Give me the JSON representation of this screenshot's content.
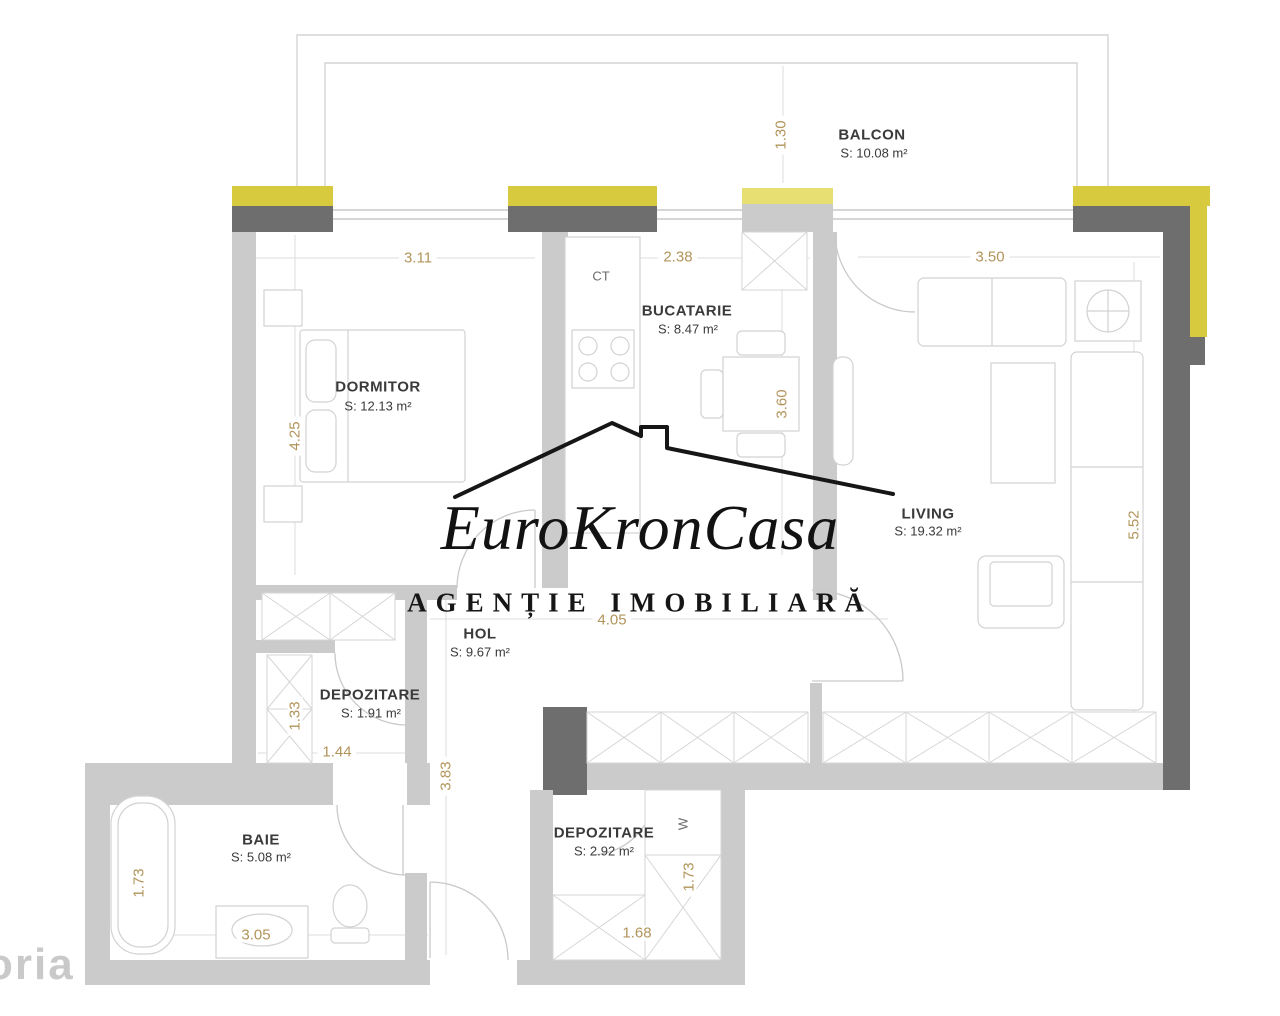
{
  "watermark": {
    "brand_script": "EuroKronCasa",
    "brand_line": "AGENȚIE IMOBILIARĂ",
    "corner": "oria"
  },
  "rooms": {
    "balcon": {
      "name": "BALCON",
      "area": "S: 10.08 m²"
    },
    "dormitor": {
      "name": "DORMITOR",
      "area": "S: 12.13 m²"
    },
    "bucatarie": {
      "name": "BUCATARIE",
      "area": "S: 8.47 m²"
    },
    "living": {
      "name": "LIVING",
      "area": "S: 19.32 m²"
    },
    "hol": {
      "name": "HOL",
      "area": "S: 9.67 m²"
    },
    "depozitare_mic": {
      "name": "DEPOZITARE",
      "area": "S: 1.91 m²"
    },
    "baie": {
      "name": "BAIE",
      "area": "S: 5.08 m²"
    },
    "depozitare_mare": {
      "name": "DEPOZITARE",
      "area": "S: 2.92 m²"
    }
  },
  "dimensions": {
    "balcon_depth": "1.30",
    "dormitor_w": "3.11",
    "bucatarie_w": "2.38",
    "living_w": "3.50",
    "dormitor_h": "4.25",
    "bucatarie_h": "3.60",
    "living_h": "5.52",
    "hol_w": "4.05",
    "dep_mic_h": "1.33",
    "dep_mic_w": "1.44",
    "hol_h": "3.83",
    "baie_h": "1.73",
    "baie_w": "3.05",
    "dep_mare_w": "1.68",
    "dep_mare_h": "1.73"
  },
  "labels": {
    "boiler": "CT",
    "washer": "W"
  },
  "colors": {
    "exterior_wall": "#6e6e6e",
    "interior_wall": "#cbcbcb",
    "accent_yellow": "#d8ca3e",
    "accent_yellow_pale": "#e7df72",
    "dimension_text": "#b2945b",
    "room_text": "#3a3a3a"
  }
}
